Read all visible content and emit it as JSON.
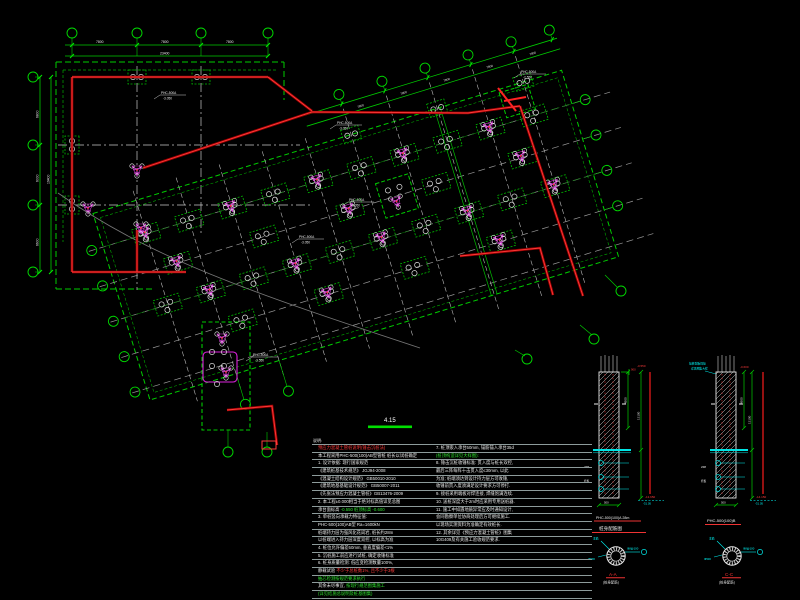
{
  "palette": {
    "background": "#000000",
    "grid_green": "#00cc00",
    "bright_green": "#00ee00",
    "wall_red": "#ff3b3b",
    "dark_red": "#9b0000",
    "pile_magenta": "#cc44cc",
    "marker_cyan": "#00ffff",
    "grid_gray": "#999999",
    "text_white": "#e8e8e8"
  },
  "plan": {
    "title": "4.15",
    "dims": {
      "top": [
        "7800",
        "7800",
        "7800"
      ],
      "top_total": "23400",
      "left": [
        "6800",
        "6000",
        "6600"
      ],
      "left_total": "19400",
      "diag": [
        "7800",
        "7800",
        "7800",
        "7800",
        "7800"
      ]
    },
    "annotations": [
      {
        "l1": "PHC-500A",
        "l2": "-3.050"
      },
      {
        "l1": "PHC-500A",
        "l2": "-3.050"
      },
      {
        "l1": "PHC-500A",
        "l2": "-2.550"
      },
      {
        "l1": "PHC-500A",
        "l2": "-3.550"
      },
      {
        "l1": "PHC-500A",
        "l2": "-3.050"
      },
      {
        "l1": "PHC-500A",
        "l2": "-3.050"
      }
    ]
  },
  "notes": {
    "heading": "说明:",
    "left": [
      {
        "t": "预应力混凝土管桩说明(锤击沉桩法)",
        "c": "r"
      },
      {
        "t": "本工程采用PHC-500(100)AB型管桩  桩长以试桩确定",
        "c": "w"
      },
      {
        "t": "1. 设计依据: 现行国家规范",
        "c": "w"
      },
      {
        "t": "   《建筑桩基技术规范》     JGJ94-2008",
        "c": "w"
      },
      {
        "t": "   《混凝土结构设计规范》   GB50010-2010",
        "c": "w"
      },
      {
        "t": "   《建筑地基基础设计规范》 GB50007-2011",
        "c": "w"
      },
      {
        "t": "   《先张法预应力混凝土管桩》GB13476-2009",
        "c": "w"
      },
      {
        "t": "2. 本工程±0.000相当于绝对标高值详见总图",
        "c": "w"
      },
      {
        "t": "   承台面标高",
        "c": "w",
        "t2": " -0.550  桩顶标高 -0.600",
        "c2": "g"
      },
      {
        "t": "3. 单桩竖向承载力特征值:",
        "c": "w"
      },
      {
        "t": "   PHC-500(100)AB型  Ra=1600kN",
        "c": "w"
      },
      {
        "t": "   桩端持力层为强风化花岗岩, 桩长约28m",
        "c": "w"
      },
      {
        "t": "   以桩端进入持力层深度双控, 以标高为准",
        "c": "w"
      },
      {
        "t": "4. 桩位允许偏差50mm, 垂直度偏差<1%",
        "c": "w"
      },
      {
        "t": "5. 沉桩施工前应进行试桩, 确定收锤标准",
        "c": "w"
      },
      {
        "t": "6. 桩身质量检测: 低应变检测数量100%,",
        "c": "w"
      },
      {
        "t": "   静载试验",
        "c": "w",
        "t2": " 不少于总桩数1%, 且不少于3根",
        "c2": "r"
      },
      {
        "t": "   抽芯检测按规范要求执行",
        "c": "g"
      },
      {
        "t": "   其余未尽事宜,",
        "c": "w",
        "t2": " 按现行规范图集施工",
        "c2": "g"
      },
      {
        "t": "   (详见结施总说明及桩基图集)",
        "c": "g"
      }
    ],
    "right": [
      {
        "t": "7. 桩顶嵌入承台50mm, 锚筋锚入承台35d",
        "c": "w"
      },
      {
        "t": "   (桩顶构造详见大样图):",
        "c": "g"
      },
      {
        "t": "8. 锤击沉桩收锤标准: 贯入度与桩长双控,",
        "c": "w"
      },
      {
        "t": "   最后三阵每阵十击贯入度≤30mm, 以此",
        "c": "w"
      },
      {
        "t": "   为准; 桩端须达到设计持力层方可收锤,",
        "c": "w"
      },
      {
        "t": "   收锤前贯入度须满足设计要求方可停打.",
        "c": "w"
      },
      {
        "t": "9. 接桩采用端板对焊连接, 焊缝饱满连续.",
        "c": "w"
      },
      {
        "t": "10. 送桩深度大于2m时应采用专用送桩器.",
        "c": "w"
      },
      {
        "t": "11. 施工中如遇地质异常应及时通知设计,",
        "c": "w"
      },
      {
        "t": "    会同勘察单位协商处理后方可继续施工.",
        "c": "w"
      },
      {
        "t": "    以现场实测资料为准确定有效桩长.",
        "c": "w"
      },
      {
        "t": "12. 其余详见《预应力混凝土管桩》图集",
        "c": "w"
      },
      {
        "t": "    10G409及有关施工验收规范要求.",
        "c": "w"
      }
    ]
  },
  "details": {
    "d1": {
      "red_top": "-0.550",
      "anchor": "900",
      "dim_a": "4500",
      "dim_b": "13100",
      "red_bottom": "-13.650",
      "cyan_bottom": "-31.05",
      "width": "500",
      "micro1": "2Φ8",
      "micro2": "托板",
      "t1": "PHC-500(100)A 28m",
      "t2": "桩身配筋图"
    },
    "d2": {
      "note1": "接桩端板焊接",
      "note2": "详见图集大样",
      "red_top": "-0.600",
      "dim_a": "4500",
      "dim_b": "13100",
      "red_bottom": "-14.150",
      "cyan_bottom": "-31.05",
      "width": "500",
      "micro1": "2Φ8",
      "micro2": "托板",
      "t1": "PHC-500(100)B"
    },
    "s1": {
      "label": "A-A",
      "sub": "(桩身配筋)",
      "c1": "Φ8@100",
      "c2": "主筋",
      "c3": "Φ500"
    },
    "s2": {
      "label": "C-C",
      "sub": "(桩身配筋)",
      "c1": "Φ8@100",
      "c2": "主筋",
      "c3": "Φ500"
    }
  }
}
